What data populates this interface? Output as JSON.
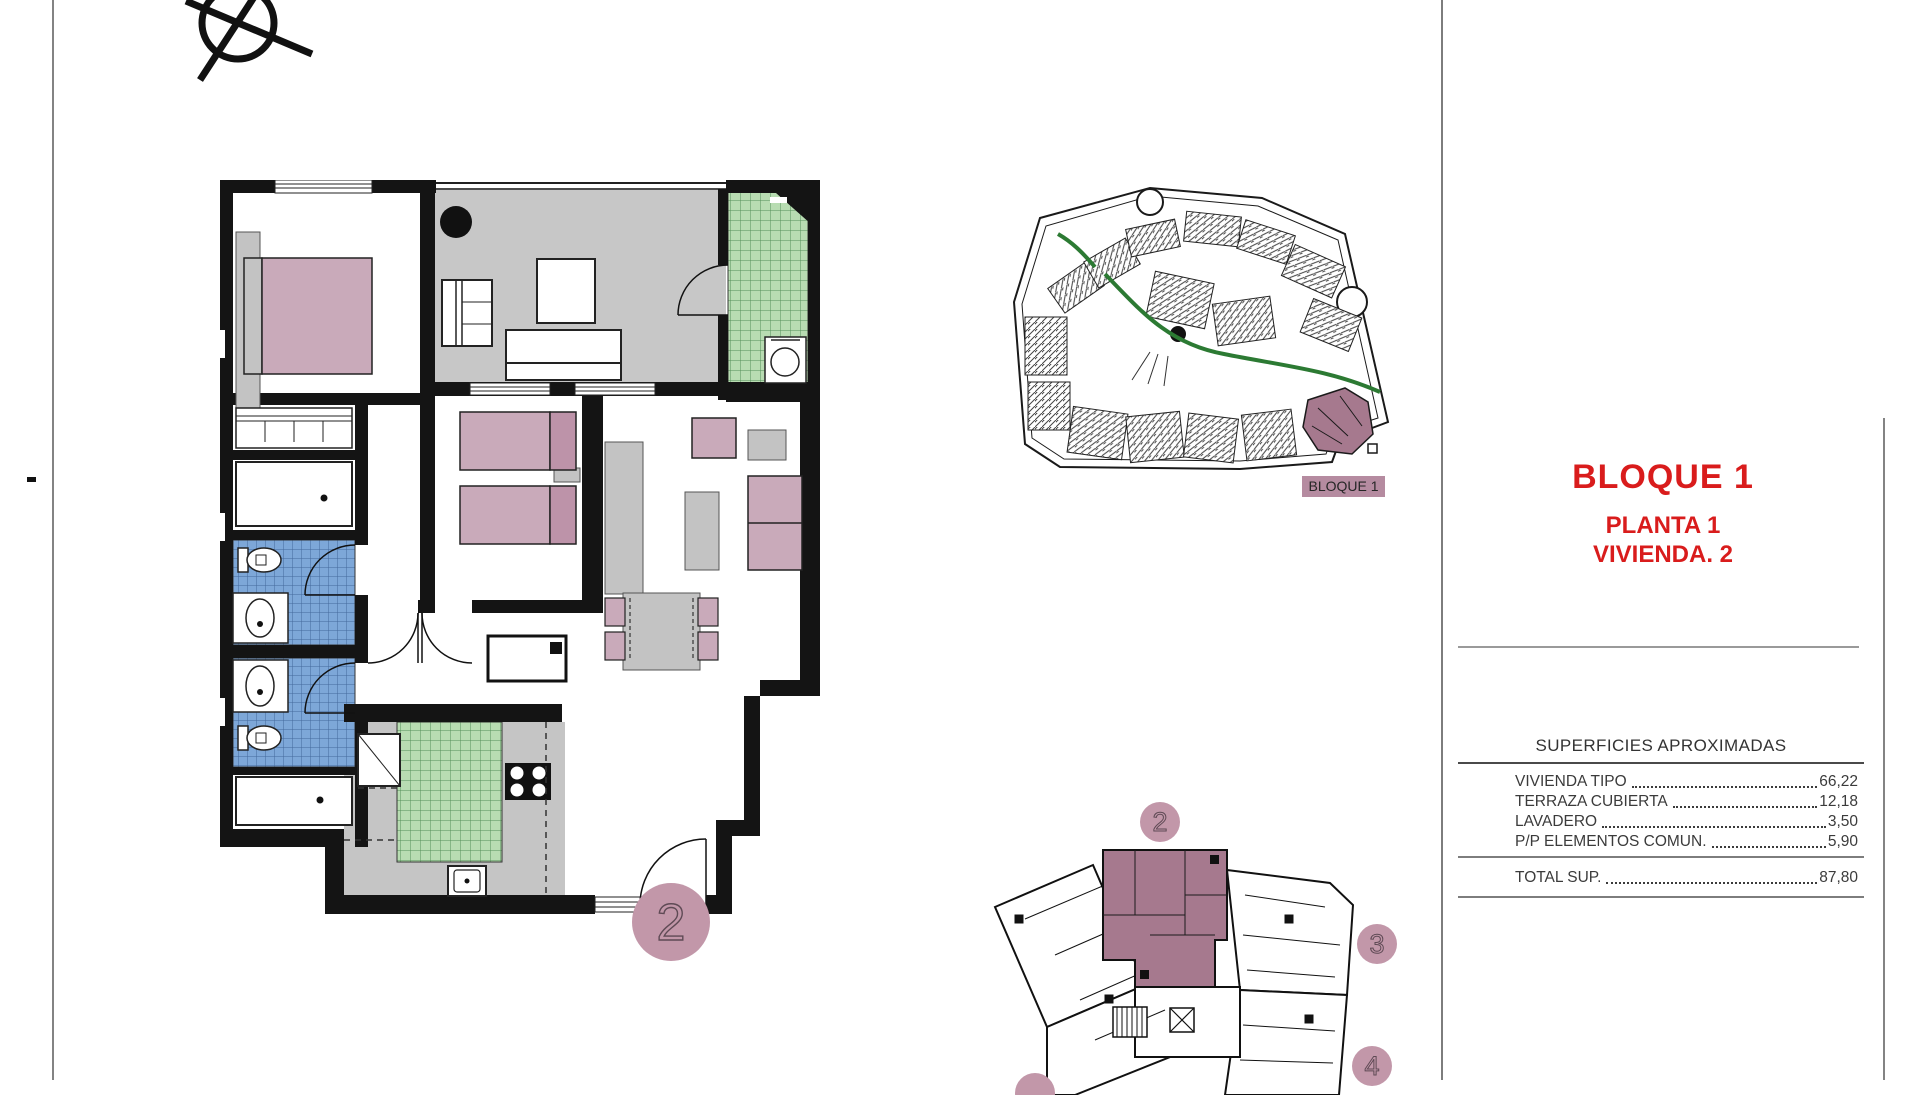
{
  "sheet": {
    "compass_icon": "north-arrow-icon",
    "background": "#ffffff"
  },
  "title_block": {
    "block_title": "BLOQUE 1",
    "floor_label": "PLANTA 1",
    "unit_label": "VIVIENDA. 2",
    "accent_color": "#d91c1c"
  },
  "areas_table": {
    "title": "SUPERFICIES APROXIMADAS",
    "rows": [
      {
        "label": "VIVIENDA TIPO",
        "value": "66,22"
      },
      {
        "label": "TERRAZA CUBIERTA",
        "value": "12,18"
      },
      {
        "label": "LAVADERO",
        "value": "3,50"
      },
      {
        "label": "P/P ELEMENTOS COMUN.",
        "value": "5,90"
      }
    ],
    "total": {
      "label": "TOTAL SUP.",
      "value": "87,80"
    }
  },
  "site_plan": {
    "highlight_label": "BLOQUE 1",
    "highlight_color": "#a6798e",
    "path_color": "#2c7a33"
  },
  "floor_plan": {
    "unit_badge": "2",
    "badge_color": "#c297a9",
    "bathroom_tile_color": "#7da7d8",
    "kitchen_tile_color": "#b8dcb2",
    "terrace_color": "#c7c7c7",
    "furniture_color": "#c9aaba"
  },
  "key_plan": {
    "highlighted_unit": "2",
    "badges": [
      "2",
      "3",
      "4"
    ],
    "unit_fill": "#a6798e"
  }
}
